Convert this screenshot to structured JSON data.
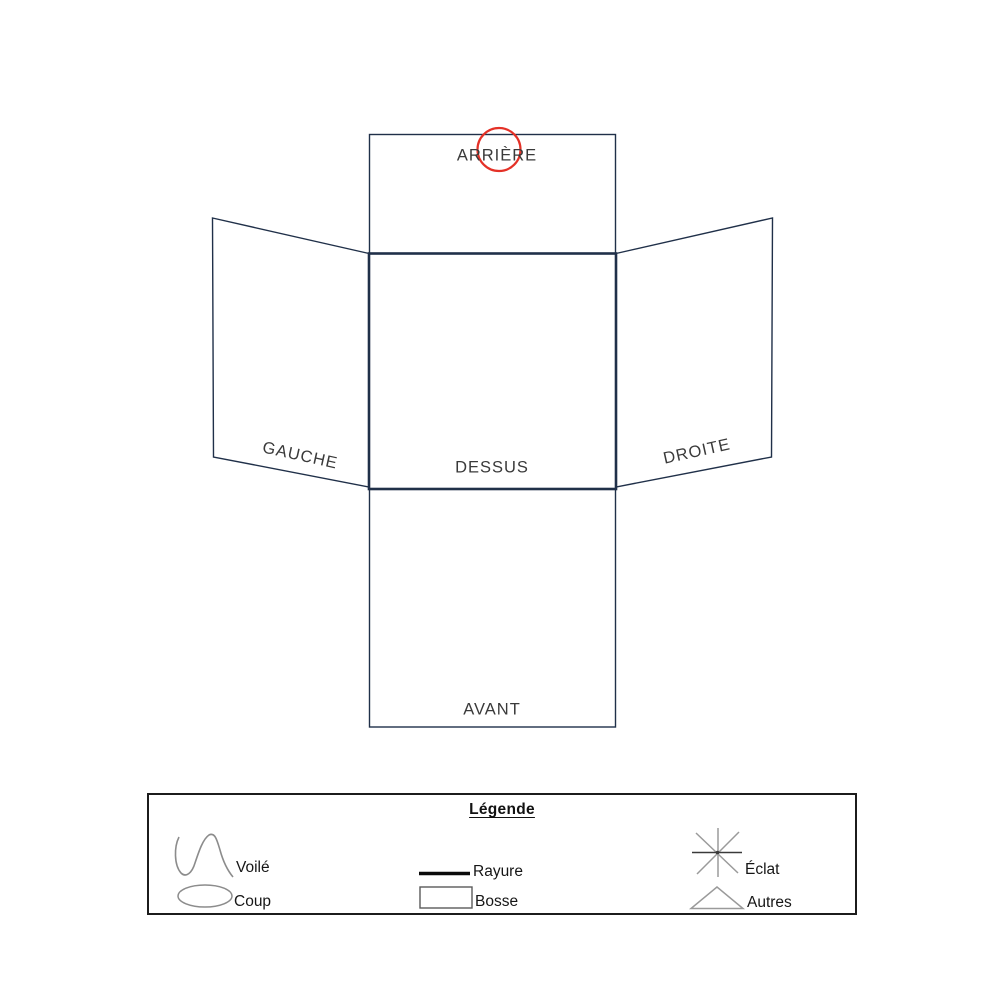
{
  "diagram": {
    "name": "Schéma d'état — vue dépliée (box net)",
    "panels": [
      {
        "id": "arriere",
        "label": "ARRIÈRE"
      },
      {
        "id": "gauche",
        "label": "GAUCHE"
      },
      {
        "id": "dessus",
        "label": "DESSUS"
      },
      {
        "id": "droite",
        "label": "DROITE"
      },
      {
        "id": "avant",
        "label": "AVANT"
      }
    ],
    "marker": {
      "type": "hand-drawn-circle",
      "panel": "arriere",
      "color": "#e43127"
    }
  },
  "legend": {
    "title": "Légende",
    "items": [
      {
        "symbol": "wave-icon",
        "label": "Voilé"
      },
      {
        "symbol": "ellipse-icon",
        "label": "Coup"
      },
      {
        "symbol": "thick-line-icon",
        "label": "Rayure"
      },
      {
        "symbol": "rectangle-icon",
        "label": "Bosse"
      },
      {
        "symbol": "star-icon",
        "label": "Éclat"
      },
      {
        "symbol": "triangle-icon",
        "label": "Autres"
      }
    ]
  },
  "colors": {
    "panel_line": "#203049",
    "marker_red": "#e43127",
    "symbol_gray": "#9a9a9a",
    "legend_border": "#1c1c1c",
    "label_text": "#3a3a3a"
  }
}
